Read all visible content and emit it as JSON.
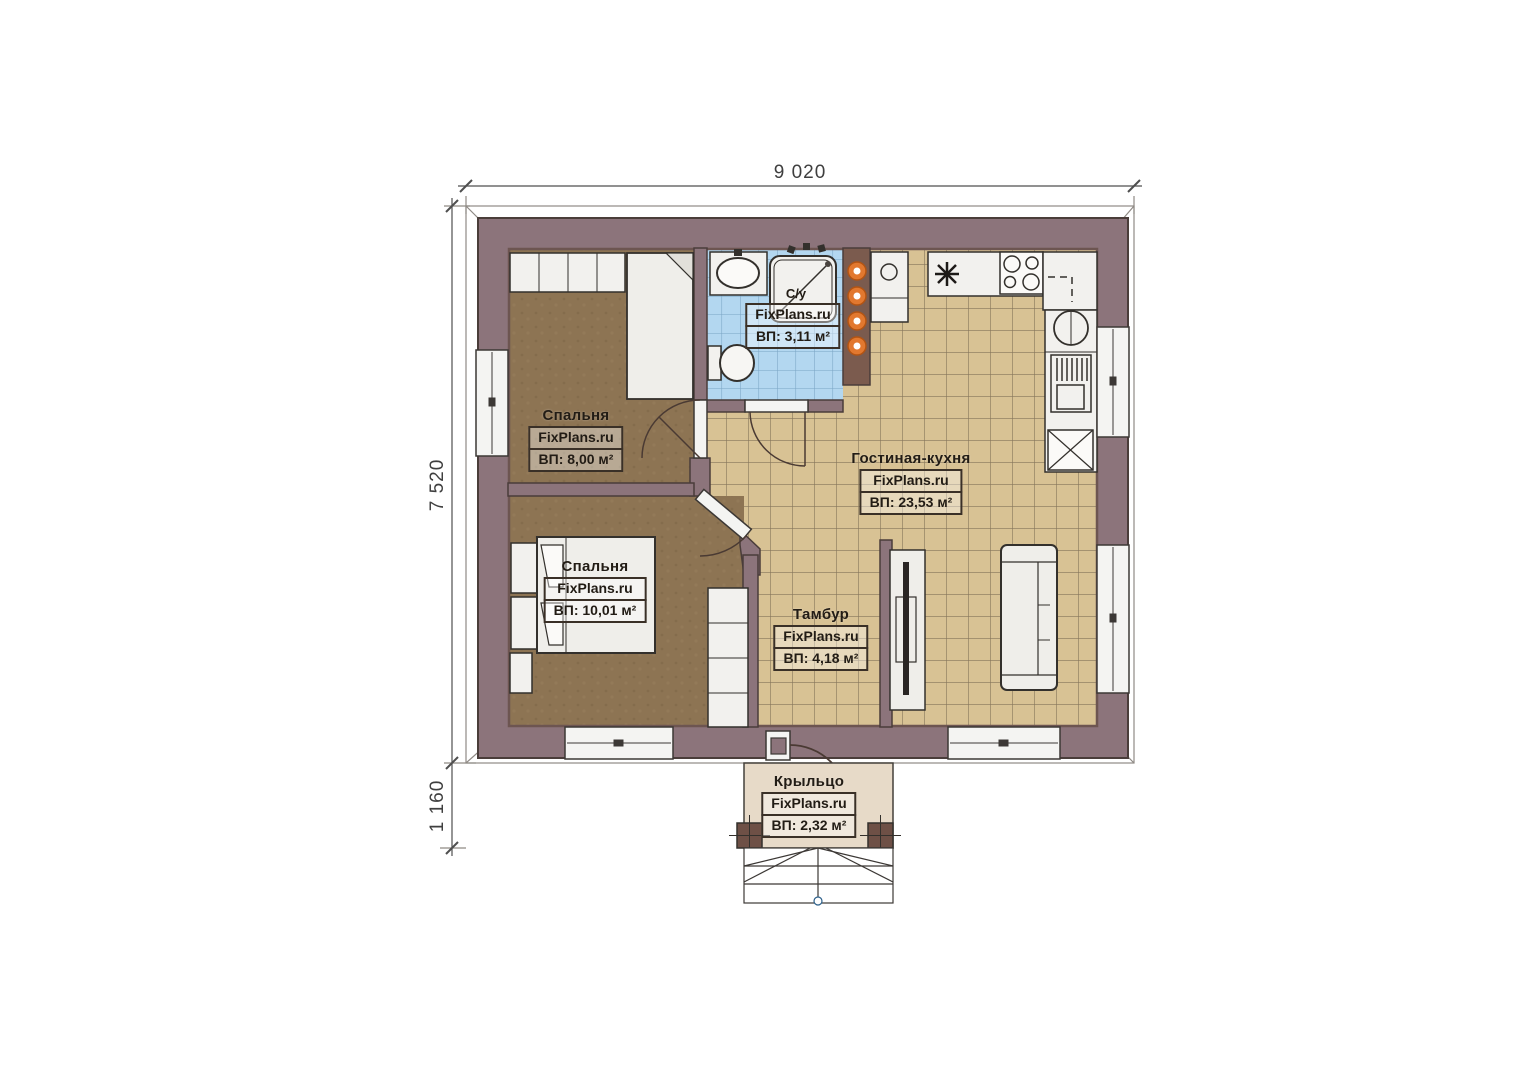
{
  "meta": {
    "watermark": "FixPlans.ru"
  },
  "dimensions": {
    "top_width": "9 020",
    "left_height": "7 520",
    "porch_depth": "1 160"
  },
  "rooms": {
    "bedroom1": {
      "name": "Спальня",
      "area": "ВП: 8,00 м²"
    },
    "bedroom2": {
      "name": "Спальня",
      "area": "ВП: 10,01 м²"
    },
    "bathroom": {
      "name": "С/у",
      "area": "ВП: 3,11 м²"
    },
    "living": {
      "name": "Гостиная-кухня",
      "area": "ВП: 23,53 м²"
    },
    "tambour": {
      "name": "Тамбур",
      "area": "ВП: 4,18 м²"
    },
    "porch": {
      "name": "Крыльцо",
      "area": "ВП: 2,32 м²"
    }
  },
  "colors": {
    "wall": "#8c747b",
    "wall_liner": "#6d5551",
    "floor_wood": "#8d7453",
    "floor_tile": "#d8c294",
    "floor_bath": "#b3d7f0",
    "porch": "#e7dac8",
    "accent_orange": "#e2782f"
  }
}
